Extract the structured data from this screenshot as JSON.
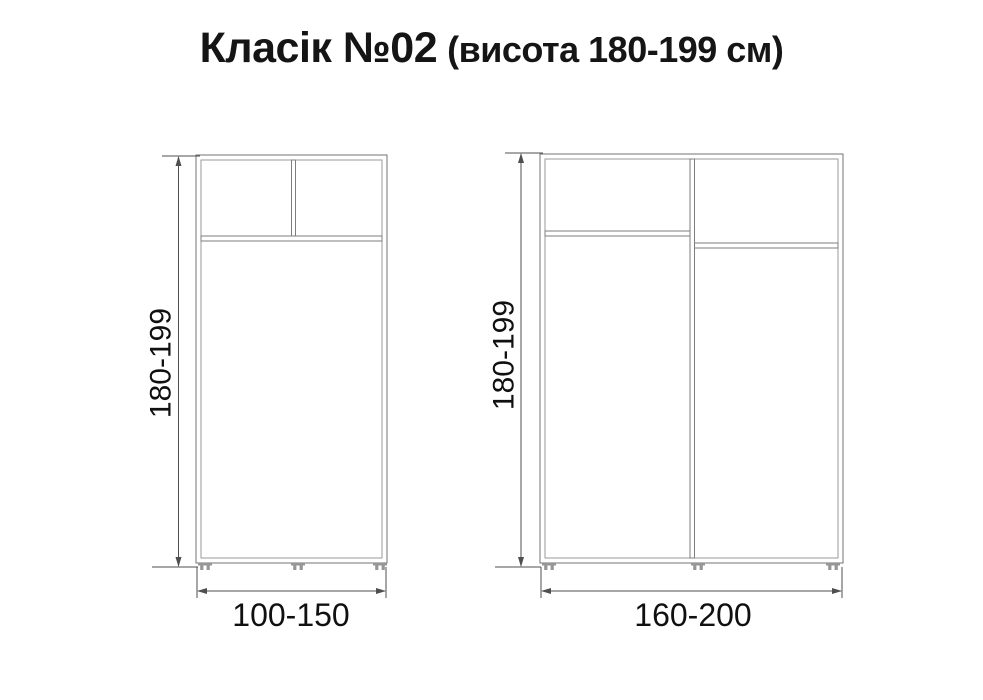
{
  "title": {
    "main": "Класік №02",
    "suffix": "(висота 180-199 см)"
  },
  "diagrams": {
    "left_wardrobe": {
      "height_label": "180-199",
      "width_label": "100-150"
    },
    "right_wardrobe": {
      "height_label": "180-199",
      "width_label": "160-200"
    }
  },
  "colors": {
    "background": "#ffffff",
    "cabinet_line": "#737373",
    "dimension_line": "#4f4f4f",
    "label_text": "#101010",
    "title_text": "#151515"
  }
}
